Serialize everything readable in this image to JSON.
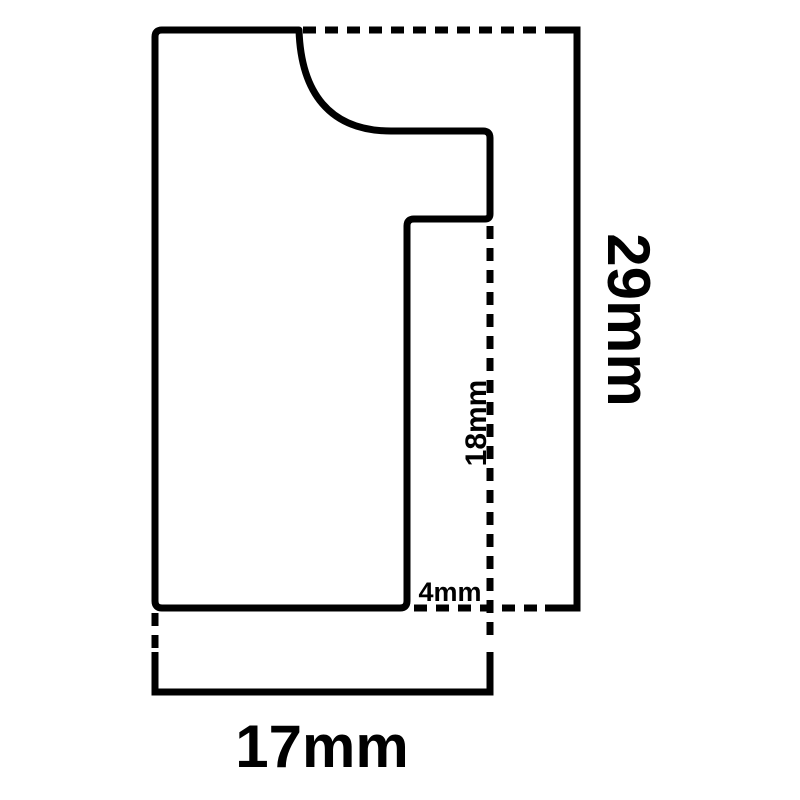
{
  "diagram": {
    "background_color": "#ffffff",
    "line_color": "#000000",
    "labels": {
      "overall_height": "29mm",
      "inner_height": "18mm",
      "rebate_width": "4mm",
      "overall_width": "17mm"
    }
  }
}
